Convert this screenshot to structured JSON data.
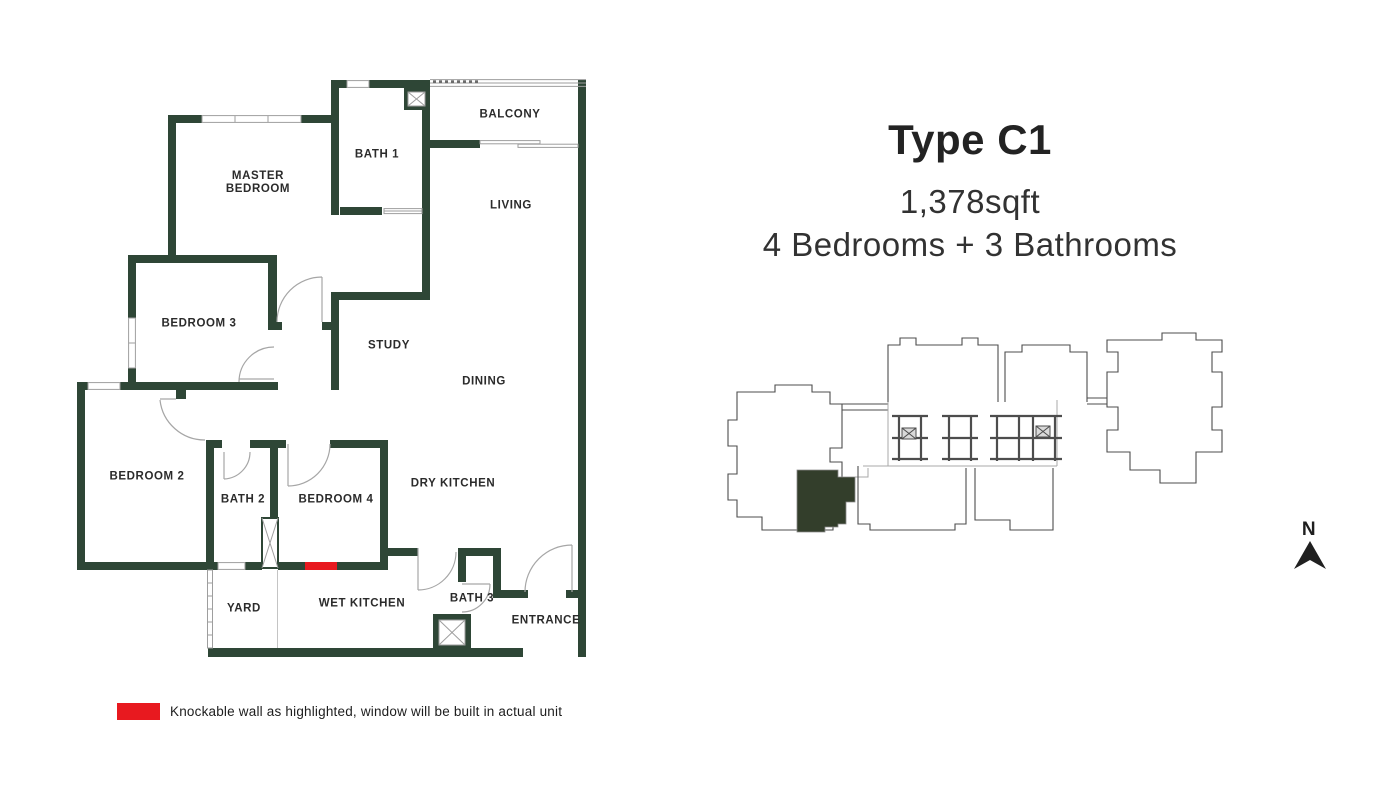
{
  "title_block": {
    "unit_type": "Type C1",
    "area": "1,378sqft",
    "configuration": "4 Bedrooms + 3 Bathrooms"
  },
  "floorplan": {
    "rooms": [
      {
        "id": "balcony",
        "label": "BALCONY"
      },
      {
        "id": "bath-1",
        "label": "BATH 1"
      },
      {
        "id": "master-bedroom",
        "label": "MASTER BEDROOM"
      },
      {
        "id": "living",
        "label": "LIVING"
      },
      {
        "id": "bedroom-3",
        "label": "BEDROOM 3"
      },
      {
        "id": "study",
        "label": "STUDY"
      },
      {
        "id": "dining",
        "label": "DINING"
      },
      {
        "id": "bedroom-2",
        "label": "BEDROOM 2"
      },
      {
        "id": "bath-2",
        "label": "BATH 2"
      },
      {
        "id": "bedroom-4",
        "label": "BEDROOM 4"
      },
      {
        "id": "dry-kitchen",
        "label": "DRY KITCHEN"
      },
      {
        "id": "yard",
        "label": "YARD"
      },
      {
        "id": "wet-kitchen",
        "label": "WET KITCHEN"
      },
      {
        "id": "bath-3",
        "label": "BATH 3"
      },
      {
        "id": "entrance",
        "label": "ENTRANCE"
      }
    ]
  },
  "legend": {
    "note": "Knockable wall as highlighted, window will be built in actual unit"
  },
  "compass": {
    "label": "N"
  },
  "colors": {
    "wall": "#2e4636",
    "unit_highlight": "#333e2b",
    "knockable_red": "#e8191f",
    "text": "#2b2b2b",
    "thin_line": "#9e9e9e",
    "keyplan_line": "#4d4d4d"
  }
}
